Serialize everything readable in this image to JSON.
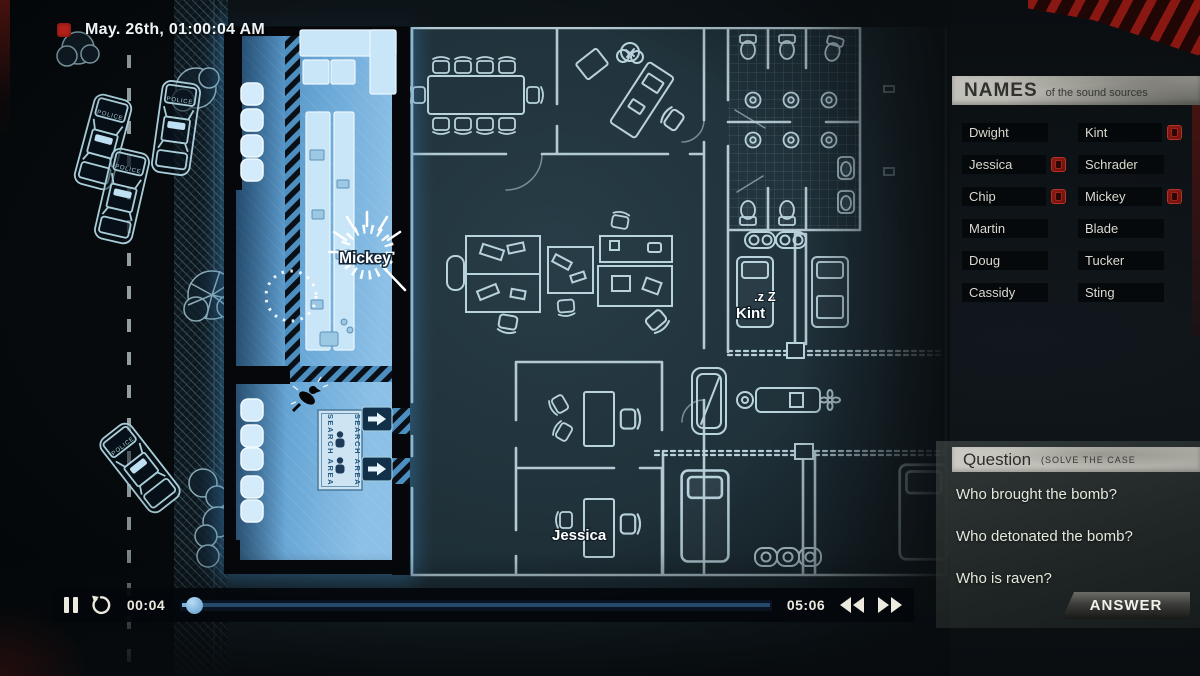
{
  "header": {
    "recording_date": "May. 26th, 01:00:04 AM"
  },
  "map": {
    "police_label": "POLICE",
    "search_area_sign": "SEARCH AREA",
    "characters": [
      {
        "name": "Mickey",
        "status": "speaking"
      },
      {
        "name": "Kint",
        "status": "sleeping",
        "sleep_indicator": ".z Z"
      },
      {
        "name": "Jessica",
        "status": "idle"
      }
    ]
  },
  "names_panel": {
    "title": "NAMES",
    "subtitle": "of the sound sources",
    "left_column": [
      {
        "label": "Dwight",
        "flagged": false
      },
      {
        "label": "Jessica",
        "flagged": true
      },
      {
        "label": "Chip",
        "flagged": true
      },
      {
        "label": "Martin",
        "flagged": false
      },
      {
        "label": "Doug",
        "flagged": false
      },
      {
        "label": "Cassidy",
        "flagged": false
      }
    ],
    "right_column": [
      {
        "label": "Kint",
        "flagged": true
      },
      {
        "label": "Schrader",
        "flagged": false
      },
      {
        "label": "Mickey",
        "flagged": true
      },
      {
        "label": "Blade",
        "flagged": false
      },
      {
        "label": "Tucker",
        "flagged": false
      },
      {
        "label": "Sting",
        "flagged": false
      }
    ]
  },
  "question_panel": {
    "title": "Question",
    "subtitle": "(SOLVE THE CASE",
    "questions": [
      "Who brought the bomb?",
      "Who detonated the bomb?",
      "Who is raven?"
    ],
    "answer_label": "ANSWER"
  },
  "playback": {
    "current_time": "00:04",
    "total_time": "05:06",
    "progress_percent": 1.5
  },
  "colors": {
    "highlight_blue": "#5b9fd4",
    "blueprint_line": "#b9d3dc",
    "alert_red": "#a6261f"
  }
}
